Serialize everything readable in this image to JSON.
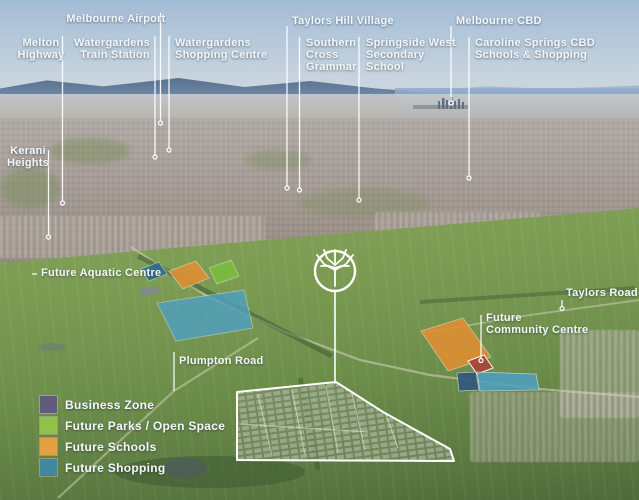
{
  "annotations": {
    "melbourne_airport": "Melbourne Airport",
    "melton_highway": "Melton\nHighway",
    "watergardens_train_station": "Watergardens\nTrain Station",
    "watergardens_shopping_centre": "Watergardens\nShopping Centre",
    "taylors_hill_village": "Taylors Hill Village",
    "southern_cross_grammar": "Southern\nCross\nGrammar",
    "springside_west_secondary_school": "Springside West\nSecondary\nSchool",
    "melbourne_cbd": "Melbourne CBD",
    "caroline_springs_cbd": "Caroline Springs CBD\nSchools & Shopping",
    "kerani_heights": "Kerani\nHeights",
    "future_aquatic_centre": "Future Aquatic Centre",
    "plumpton_road": "Plumpton Road",
    "taylors_road": "Taylors Road",
    "future_community_centre": "Future\nCommunity Centre"
  },
  "legend": {
    "items": [
      {
        "label": "Business Zone",
        "color": "#615C7D"
      },
      {
        "label": "Future Parks / Open Space",
        "color": "#92C14B"
      },
      {
        "label": "Future Schools",
        "color": "#E59F40"
      },
      {
        "label": "Future Shopping",
        "color": "#41889F"
      }
    ]
  },
  "map_zones": {
    "shopping_small_left": {
      "category": "Future Shopping",
      "color": "#2F6B8E"
    },
    "schools_left": {
      "category": "Future Schools",
      "color": "#DE8F33"
    },
    "parks_left": {
      "category": "Future Parks / Open Space",
      "color": "#79BE3E"
    },
    "shopping_large_left": {
      "category": "Future Shopping",
      "color": "#4FA0C2"
    },
    "schools_right": {
      "category": "Future Schools",
      "color": "#DE8F33"
    },
    "community_centre_site": {
      "category": "Future Community Centre",
      "color": "#A8453C"
    },
    "business_right": {
      "category": "Business Zone",
      "color": "#31567E"
    },
    "shopping_right": {
      "category": "Future Shopping",
      "color": "#4FA0C2"
    }
  },
  "icons": {
    "tree_logo": "tree-in-circle"
  }
}
